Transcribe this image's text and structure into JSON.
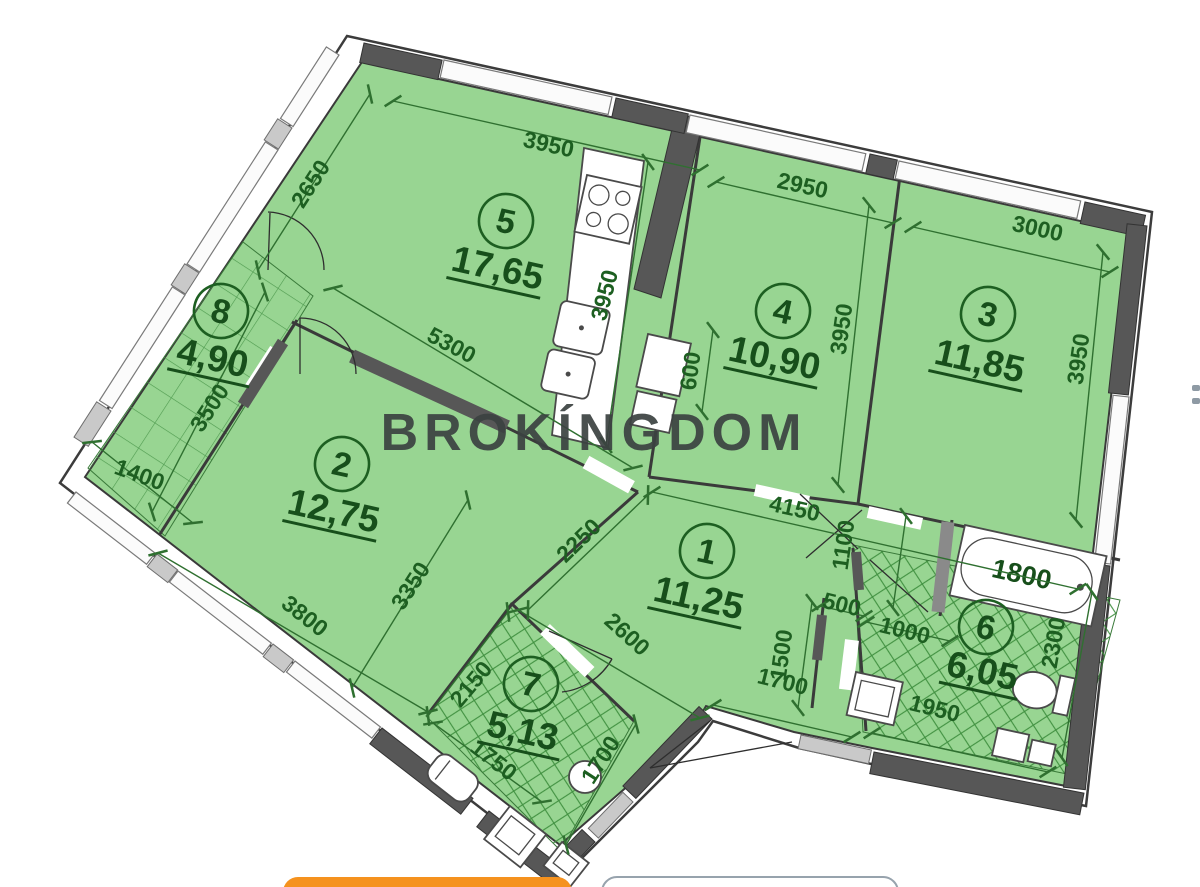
{
  "watermark_text": "BROKÍNGDOM",
  "rooms": [
    {
      "number": "1",
      "area": "11,25"
    },
    {
      "number": "2",
      "area": "12,75"
    },
    {
      "number": "3",
      "area": "11,85"
    },
    {
      "number": "4",
      "area": "10,90"
    },
    {
      "number": "5",
      "area": "17,65"
    },
    {
      "number": "6",
      "area": "6,05"
    },
    {
      "number": "7",
      "area": "5,13"
    },
    {
      "number": "8",
      "area": "4,90"
    }
  ],
  "dimensions": {
    "room5_top": "3950",
    "room5_left": "2650",
    "room5_room2_wall": "5300",
    "kitchen_side": "3950",
    "room4_top": "2950",
    "room4_side": "3950",
    "room4_niche": "600",
    "room3_top": "3000",
    "room3_side": "3950",
    "room8_length": "3500",
    "room8_width": "1400",
    "room2_bottom": "3800",
    "room2_side": "3350",
    "hall_top": "4150",
    "hall_left": "2250",
    "hall_right": "1100",
    "hall_bottom": "2600",
    "entry_depth": "1500",
    "entry_step": "500",
    "entry_width": "1000",
    "entry_front": "1700",
    "bath6_width": "1950",
    "bath6_side": "2300",
    "bathtub_length": "1800",
    "bath7_side": "2150",
    "bath7_bottom": "1750",
    "bath7_right": "1700"
  },
  "colors": {
    "plan_green": "#98d592",
    "wall_dark": "#575757",
    "label_green": "#1d5f21",
    "watermark_gray": "#3b4241",
    "button_orange": "#f5921e"
  }
}
